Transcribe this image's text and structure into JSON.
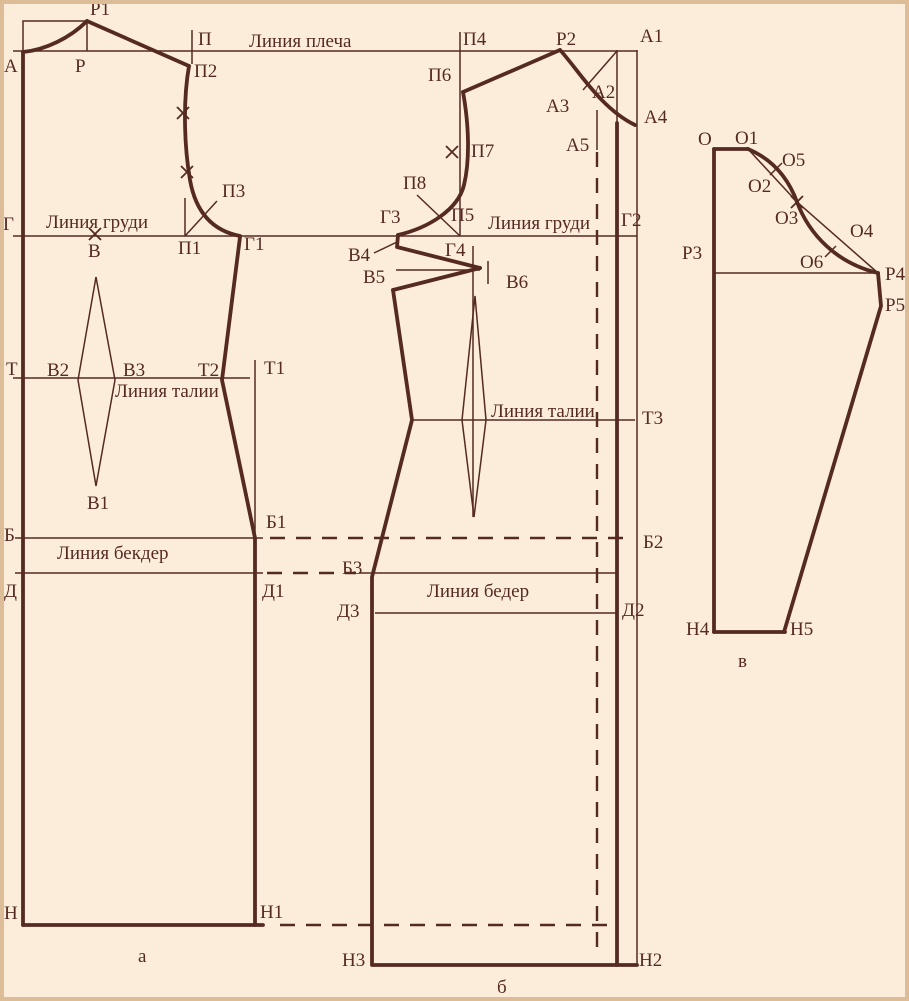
{
  "colors": {
    "background": "#fcedda",
    "ink": "#552a21",
    "border": "#dcbd97"
  },
  "guide_labels": [
    {
      "id": "shoulder-line-label",
      "text": "Линия плеча",
      "x": 249,
      "y": 47
    },
    {
      "id": "chest-line-label-back",
      "text": "Линия груди",
      "x": 46,
      "y": 228
    },
    {
      "id": "chest-line-label-front",
      "text": "Линия груди",
      "x": 488,
      "y": 229
    },
    {
      "id": "waist-line-label-back",
      "text": "Линия талии",
      "x": 115,
      "y": 397
    },
    {
      "id": "waist-line-label-front",
      "text": "Линия талии",
      "x": 491,
      "y": 417
    },
    {
      "id": "hip-line-label-back",
      "text": "Линия бекдер",
      "x": 57,
      "y": 559
    },
    {
      "id": "hip-line-label-front",
      "text": "Линия бедер",
      "x": 427,
      "y": 597
    }
  ],
  "point_labels": [
    {
      "id": "point-label-r1",
      "text": "Р1",
      "x": 90,
      "y": 15
    },
    {
      "id": "point-label-a",
      "text": "А",
      "x": 4,
      "y": 72
    },
    {
      "id": "point-label-r",
      "text": "Р",
      "x": 75,
      "y": 72
    },
    {
      "id": "point-label-p",
      "text": "П",
      "x": 198,
      "y": 45
    },
    {
      "id": "point-label-p2",
      "text": "П2",
      "x": 194,
      "y": 77
    },
    {
      "id": "point-label-p3",
      "text": "П3",
      "x": 222,
      "y": 197
    },
    {
      "id": "point-label-p1",
      "text": "П1",
      "x": 178,
      "y": 254
    },
    {
      "id": "point-label-g",
      "text": "Г",
      "x": 3,
      "y": 230
    },
    {
      "id": "point-label-v",
      "text": "В",
      "x": 88,
      "y": 257
    },
    {
      "id": "point-label-g1",
      "text": "Г1",
      "x": 244,
      "y": 250
    },
    {
      "id": "point-label-t",
      "text": "Т",
      "x": 6,
      "y": 375
    },
    {
      "id": "point-label-v2",
      "text": "В2",
      "x": 47,
      "y": 376
    },
    {
      "id": "point-label-v3",
      "text": "В3",
      "x": 123,
      "y": 376
    },
    {
      "id": "point-label-t2",
      "text": "Т2",
      "x": 198,
      "y": 376
    },
    {
      "id": "point-label-t1",
      "text": "Т1",
      "x": 264,
      "y": 374
    },
    {
      "id": "point-label-v1",
      "text": "В1",
      "x": 87,
      "y": 509
    },
    {
      "id": "point-label-b",
      "text": "Б",
      "x": 4,
      "y": 541
    },
    {
      "id": "point-label-b1",
      "text": "Б1",
      "x": 266,
      "y": 528
    },
    {
      "id": "point-label-d",
      "text": "Д",
      "x": 4,
      "y": 597
    },
    {
      "id": "point-label-d1",
      "text": "Д1",
      "x": 262,
      "y": 597
    },
    {
      "id": "point-label-n",
      "text": "Н",
      "x": 4,
      "y": 919
    },
    {
      "id": "point-label-n1",
      "text": "Н1",
      "x": 260,
      "y": 918
    },
    {
      "id": "point-label-p4",
      "text": "П4",
      "x": 463,
      "y": 45
    },
    {
      "id": "point-label-r2",
      "text": "Р2",
      "x": 556,
      "y": 45
    },
    {
      "id": "point-label-a1",
      "text": "А1",
      "x": 640,
      "y": 42
    },
    {
      "id": "point-label-p6",
      "text": "П6",
      "x": 428,
      "y": 81
    },
    {
      "id": "point-label-a2",
      "text": "А2",
      "x": 592,
      "y": 98
    },
    {
      "id": "point-label-a3",
      "text": "А3",
      "x": 546,
      "y": 112
    },
    {
      "id": "point-label-a4",
      "text": "А4",
      "x": 644,
      "y": 123
    },
    {
      "id": "point-label-a5",
      "text": "А5",
      "x": 566,
      "y": 151
    },
    {
      "id": "point-label-p7",
      "text": "П7",
      "x": 471,
      "y": 157
    },
    {
      "id": "point-label-p8",
      "text": "П8",
      "x": 403,
      "y": 189
    },
    {
      "id": "point-label-g3",
      "text": "Г3",
      "x": 380,
      "y": 223
    },
    {
      "id": "point-label-p5",
      "text": "П5",
      "x": 451,
      "y": 221
    },
    {
      "id": "point-label-g2",
      "text": "Г2",
      "x": 621,
      "y": 226
    },
    {
      "id": "point-label-v4",
      "text": "В4",
      "x": 348,
      "y": 261
    },
    {
      "id": "point-label-g4",
      "text": "Г4",
      "x": 445,
      "y": 256
    },
    {
      "id": "point-label-v5",
      "text": "В5",
      "x": 363,
      "y": 283
    },
    {
      "id": "point-label-v6",
      "text": "В6",
      "x": 506,
      "y": 288
    },
    {
      "id": "point-label-t3",
      "text": "Т3",
      "x": 642,
      "y": 424
    },
    {
      "id": "point-label-b2",
      "text": "Б2",
      "x": 643,
      "y": 548
    },
    {
      "id": "point-label-b3",
      "text": "Б3",
      "x": 342,
      "y": 574
    },
    {
      "id": "point-label-d3",
      "text": "Д3",
      "x": 337,
      "y": 617
    },
    {
      "id": "point-label-d2",
      "text": "Д2",
      "x": 622,
      "y": 616
    },
    {
      "id": "point-label-n3",
      "text": "Н3",
      "x": 342,
      "y": 966
    },
    {
      "id": "point-label-n2",
      "text": "Н2",
      "x": 639,
      "y": 966
    },
    {
      "id": "point-label-o",
      "text": "О",
      "x": 698,
      "y": 145
    },
    {
      "id": "point-label-o1",
      "text": "О1",
      "x": 735,
      "y": 144
    },
    {
      "id": "point-label-o5",
      "text": "О5",
      "x": 782,
      "y": 166
    },
    {
      "id": "point-label-o2",
      "text": "О2",
      "x": 748,
      "y": 192
    },
    {
      "id": "point-label-o3",
      "text": "О3",
      "x": 775,
      "y": 224
    },
    {
      "id": "point-label-o4",
      "text": "О4",
      "x": 850,
      "y": 237
    },
    {
      "id": "point-label-o6",
      "text": "О6",
      "x": 800,
      "y": 268
    },
    {
      "id": "point-label-r3",
      "text": "Р3",
      "x": 682,
      "y": 259
    },
    {
      "id": "point-label-r4",
      "text": "Р4",
      "x": 885,
      "y": 280
    },
    {
      "id": "point-label-r5",
      "text": "Р5",
      "x": 885,
      "y": 311
    },
    {
      "id": "point-label-n4",
      "text": "Н4",
      "x": 686,
      "y": 635
    },
    {
      "id": "point-label-n5",
      "text": "Н5",
      "x": 790,
      "y": 635
    }
  ],
  "figure_captions": [
    {
      "id": "caption-piece-a",
      "text": "а",
      "x": 138,
      "y": 962
    },
    {
      "id": "caption-piece-b",
      "text": "б",
      "x": 497,
      "y": 993
    },
    {
      "id": "caption-piece-v",
      "text": "в",
      "x": 738,
      "y": 667
    }
  ],
  "notch_marks": [
    {
      "id": "notch-back-armhole-upper",
      "x": 183,
      "y": 113
    },
    {
      "id": "notch-back-armhole-lower",
      "x": 187,
      "y": 172
    },
    {
      "id": "notch-chest-line-v",
      "x": 95,
      "y": 234
    },
    {
      "id": "notch-front-armhole",
      "x": 452,
      "y": 152
    },
    {
      "id": "notch-sleeve-cap",
      "x": 797,
      "y": 202
    }
  ]
}
